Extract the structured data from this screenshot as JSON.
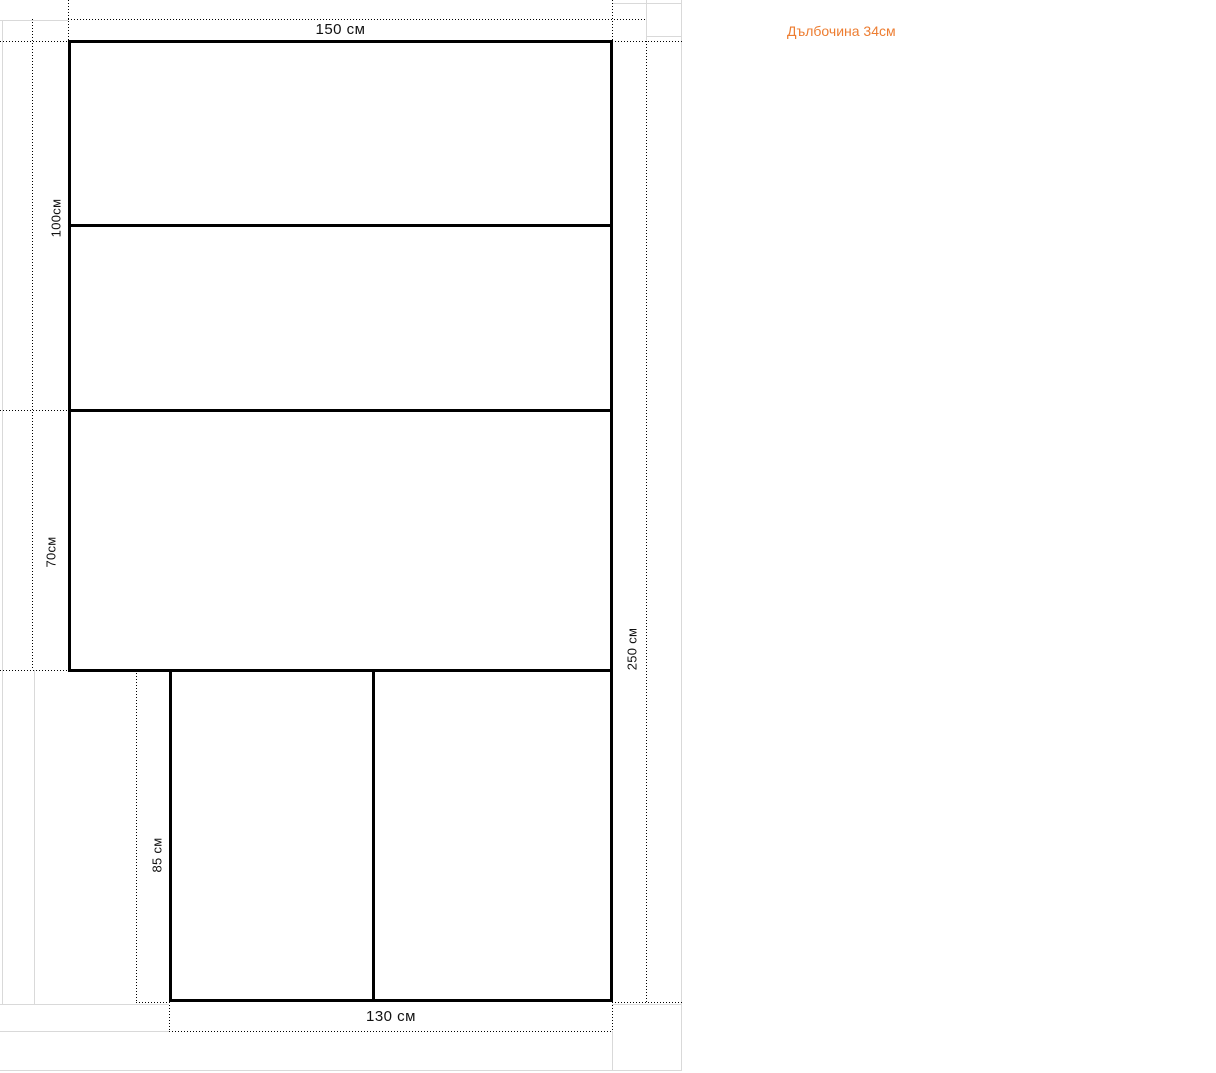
{
  "canvas": {
    "width": 1216,
    "height": 1073,
    "background": "#ffffff"
  },
  "colors": {
    "shape_outline": "#000000",
    "dimension_guides": "#000000",
    "gridlines": "#d9d9d9",
    "note_text": "#ED7D31",
    "label_text": "#111111"
  },
  "drawing": {
    "note": "Дълбочина 34см",
    "dimensions": {
      "top_width": "150 см",
      "upper_left_height": "100см",
      "lower_left_height": "70см",
      "total_height_right": "250 см",
      "bottom_section_height": "85 см",
      "bottom_width": "130 см"
    }
  }
}
